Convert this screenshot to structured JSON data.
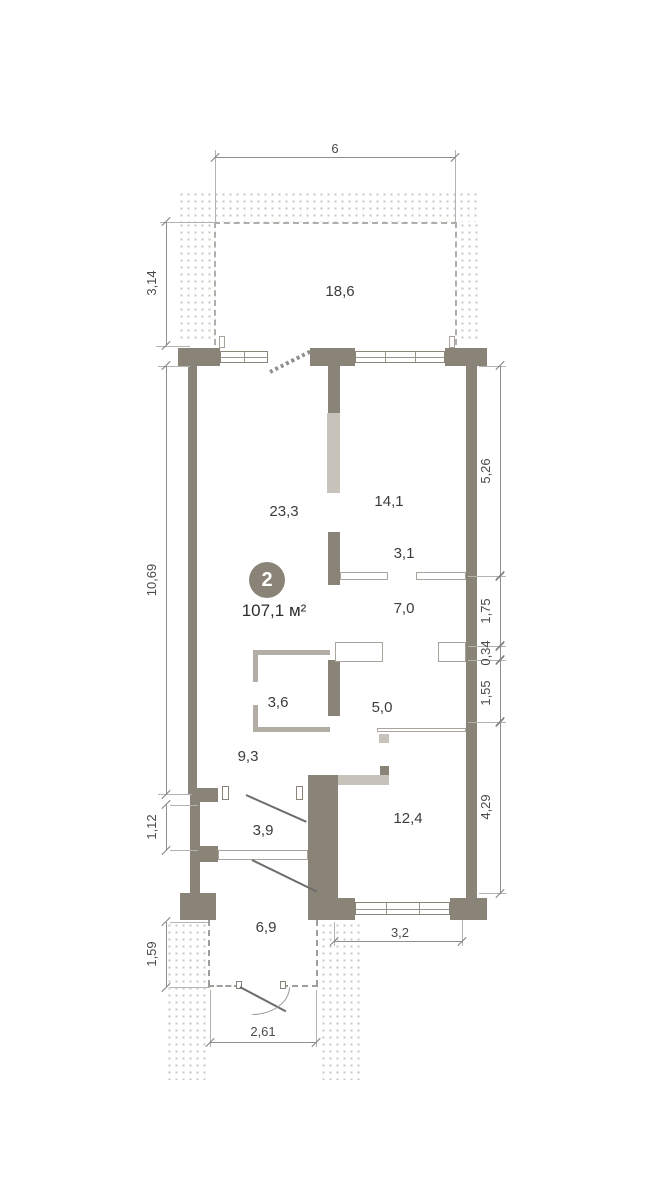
{
  "badge": {
    "number": "2",
    "total_area": "107,1 м²"
  },
  "rooms": {
    "terrace": "18,6",
    "living": "23,3",
    "kitchen_dining": "14,1",
    "hall": "3,1",
    "bathroom": "7,0",
    "wardrobe": "3,6",
    "corridor": "5,0",
    "kitchen": "9,3",
    "entry": "3,9",
    "bedroom": "12,4",
    "porch": "6,9"
  },
  "dimensions": {
    "top_width": "6",
    "terrace_depth": "3,14",
    "left_height": "10,69",
    "left_opening": "1,12",
    "porch_depth": "1,59",
    "right_top": "5,26",
    "right_upper_mid": "1,75",
    "right_wall": "0,34",
    "right_lower_mid": "1,55",
    "right_bottom": "4,29",
    "window_width": "3,2",
    "porch_width": "2,61"
  },
  "colors": {
    "wall": "#8a8478",
    "shaft": "#c7c3ba",
    "partition_stroke": "#a9a59c",
    "dimension_line": "#8f8f8d",
    "text": "#3c3c3c",
    "badge_bg": "#8a8478",
    "hatch_dot": "#c9c7c1"
  }
}
